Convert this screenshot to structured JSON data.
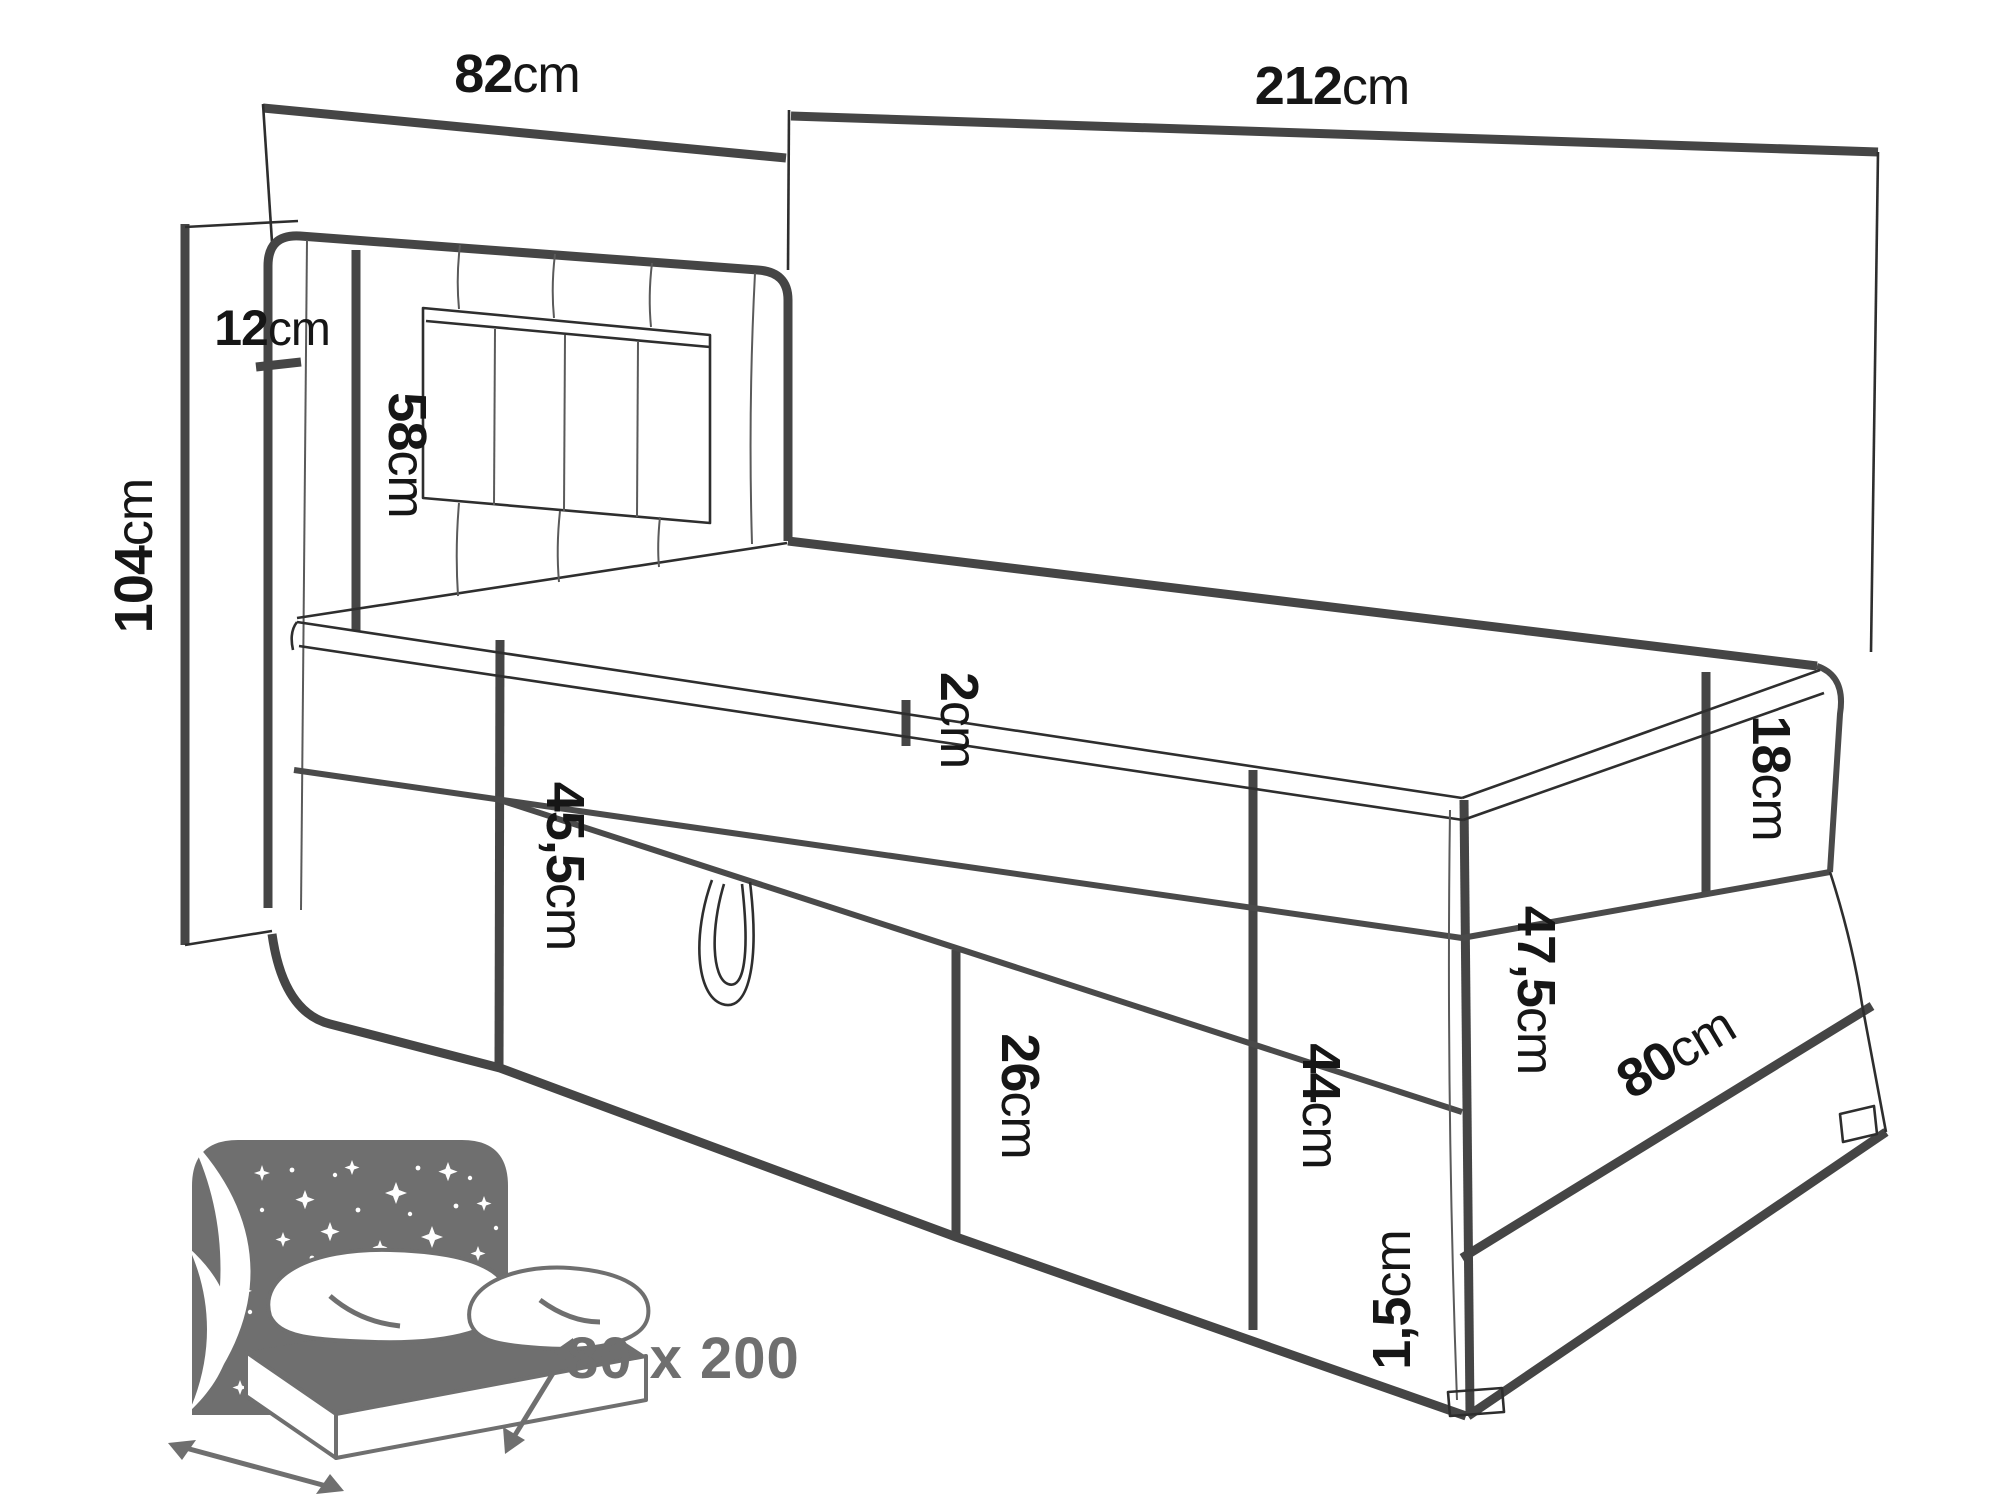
{
  "diagram": {
    "type": "furniture-dimension-line-drawing",
    "subject": "boxspring single bed with tall headboard and storage drawer",
    "units": "cm",
    "dimensions": {
      "headboard_width": {
        "value": "82",
        "unit": "cm",
        "orientation": "horizontal"
      },
      "total_length": {
        "value": "212",
        "unit": "cm",
        "orientation": "horizontal"
      },
      "total_height": {
        "value": "104",
        "unit": "cm",
        "orientation": "vertical"
      },
      "side_panel_depth": {
        "value": "12",
        "unit": "cm",
        "orientation": "horizontal"
      },
      "headboard_height": {
        "value": "58",
        "unit": "cm",
        "orientation": "vertical"
      },
      "topper_thickness": {
        "value": "2",
        "unit": "cm",
        "orientation": "vertical"
      },
      "side_rail_height": {
        "value": "45,5",
        "unit": "cm",
        "orientation": "vertical"
      },
      "drawer_front_height": {
        "value": "26",
        "unit": "cm",
        "orientation": "vertical"
      },
      "front_corner_height": {
        "value": "44",
        "unit": "cm",
        "orientation": "vertical"
      },
      "foot_end_height": {
        "value": "47,5",
        "unit": "cm",
        "orientation": "vertical"
      },
      "mattress_height": {
        "value": "18",
        "unit": "cm",
        "orientation": "vertical"
      },
      "foot_width": {
        "value": "80",
        "unit": "cm",
        "orientation": "diagonal"
      },
      "foot_glide_height": {
        "value": "1,5",
        "unit": "cm",
        "orientation": "vertical"
      }
    },
    "icon": {
      "size_label": "80 x 200",
      "description": "stylized bed with starry headboard and size arrows"
    },
    "colors": {
      "line": "#454545",
      "text": "#161616",
      "icon": "#6f6f6f",
      "background": "#ffffff"
    }
  }
}
